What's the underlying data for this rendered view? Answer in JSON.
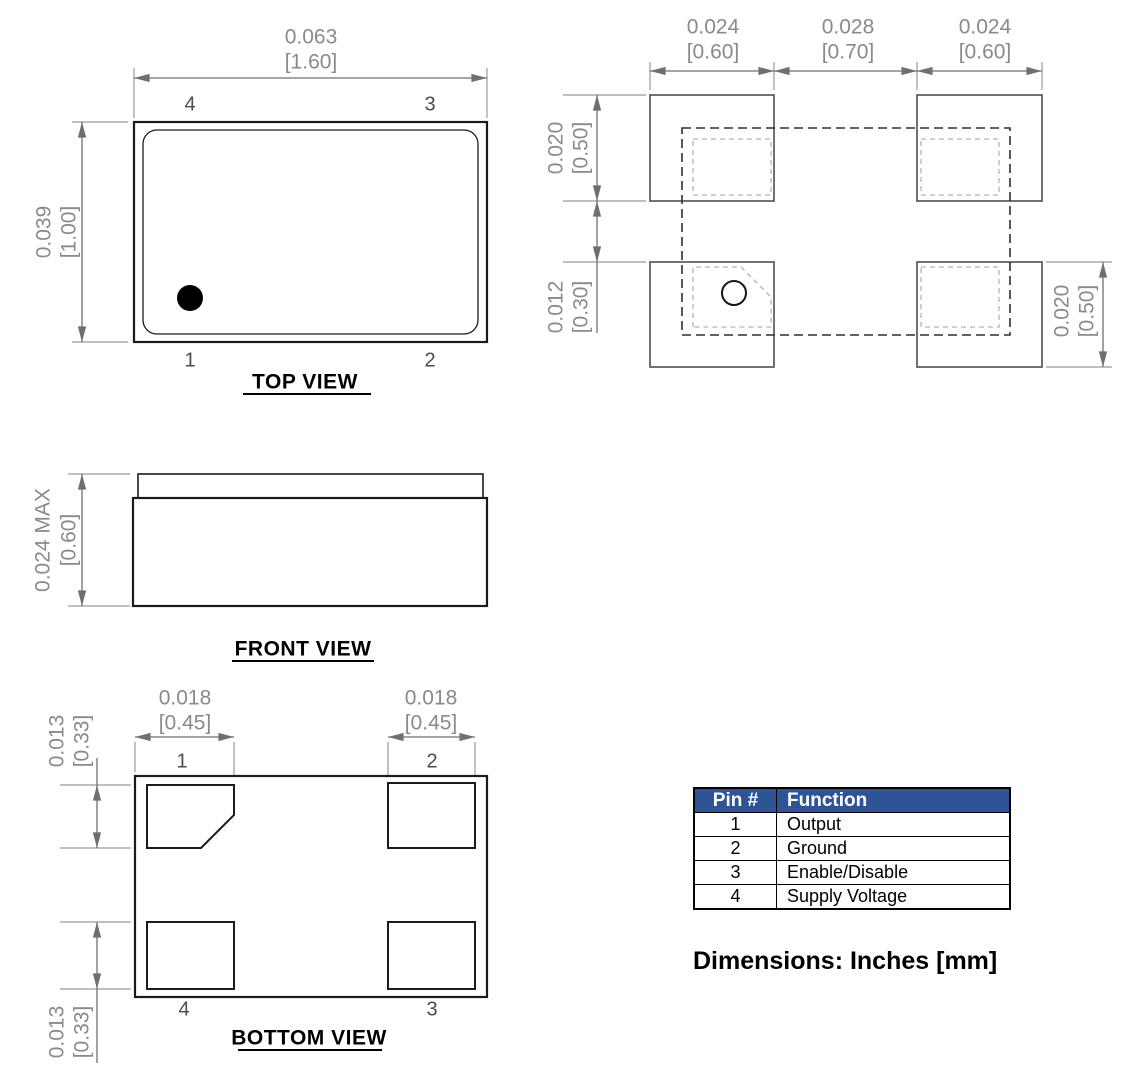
{
  "drawing": {
    "top_view": {
      "title": "TOP VIEW",
      "width_in": "0.063",
      "width_mm": "[1.60]",
      "height_in": "0.039",
      "height_mm": "[1.00]",
      "pin_top_left": "4",
      "pin_top_right": "3",
      "pin_bottom_left": "1",
      "pin_bottom_right": "2"
    },
    "front_view": {
      "title": "FRONT VIEW",
      "height_in": "0.024 MAX",
      "height_mm": "[0.60]"
    },
    "bottom_view": {
      "title": "BOTTOM VIEW",
      "left_pad_width_in": "0.018",
      "left_pad_width_mm": "[0.45]",
      "right_pad_width_in": "0.018",
      "right_pad_width_mm": "[0.45]",
      "top_pad_height_in": "0.013",
      "top_pad_height_mm": "[0.33]",
      "bottom_pad_height_in": "0.013",
      "bottom_pad_height_mm": "[0.33]",
      "pin_top_left": "1",
      "pin_top_right": "2",
      "pin_bottom_left": "4",
      "pin_bottom_right": "3"
    },
    "land_pattern": {
      "left_pad_width_in": "0.024",
      "left_pad_width_mm": "[0.60]",
      "center_gap_in": "0.028",
      "center_gap_mm": "[0.70]",
      "right_pad_width_in": "0.024",
      "right_pad_width_mm": "[0.60]",
      "left_pad_height_in": "0.020",
      "left_pad_height_mm": "[0.50]",
      "row_gap_in": "0.012",
      "row_gap_mm": "[0.30]",
      "right_pad_height_in": "0.020",
      "right_pad_height_mm": "[0.50]"
    }
  },
  "pin_table": {
    "headers": [
      "Pin #",
      "Function"
    ],
    "rows": [
      {
        "pin": "1",
        "function": "Output"
      },
      {
        "pin": "2",
        "function": "Ground"
      },
      {
        "pin": "3",
        "function": "Enable/Disable"
      },
      {
        "pin": "4",
        "function": "Supply Voltage"
      }
    ],
    "header_bg": "#2F5496",
    "header_text_color": "#FFFFFF"
  },
  "caption": "Dimensions: Inches [mm]"
}
